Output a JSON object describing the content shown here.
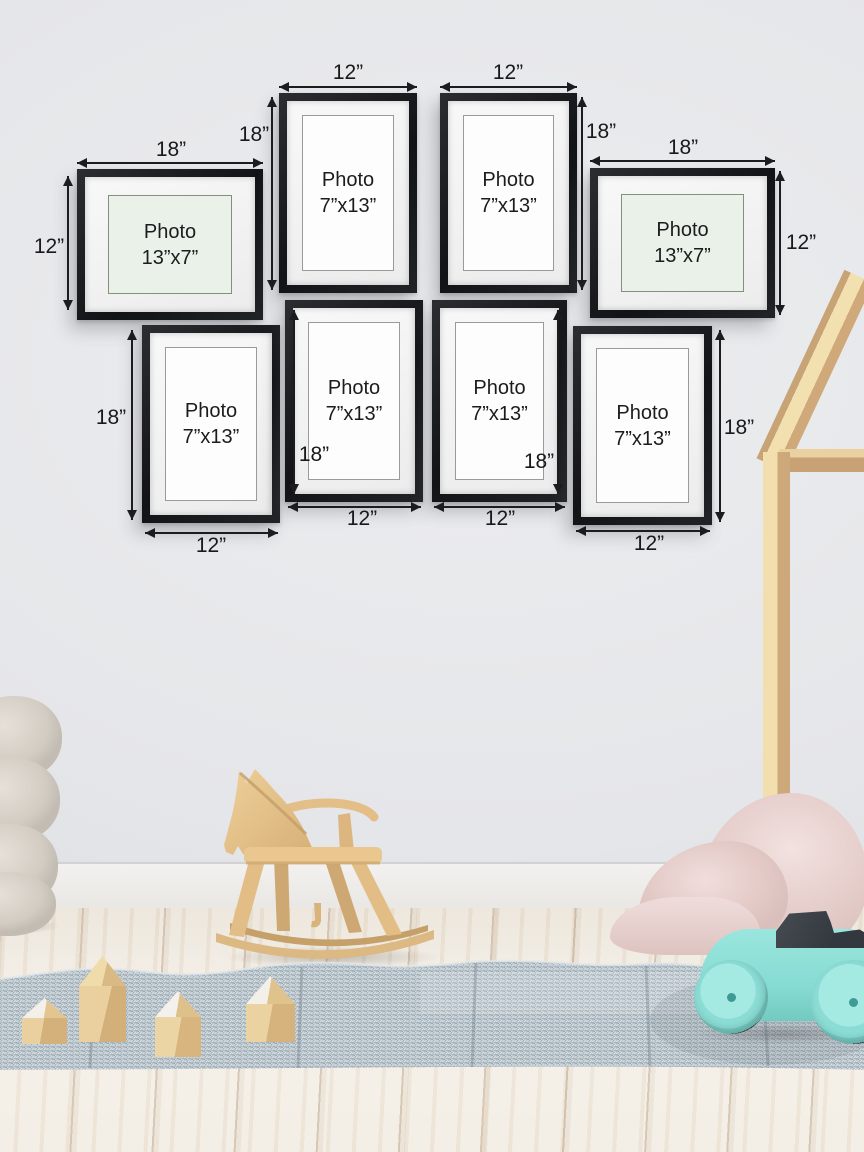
{
  "frames": [
    {
      "position": "top-left",
      "orientation": "landscape",
      "photo_line1": "Photo",
      "photo_line2": "13”x7”",
      "width_label": "18”",
      "height_label": "12”"
    },
    {
      "position": "top-middle-left",
      "orientation": "portrait",
      "photo_line1": "Photo",
      "photo_line2": "7”x13”",
      "width_label": "12”",
      "height_label": "18”"
    },
    {
      "position": "top-middle-right",
      "orientation": "portrait",
      "photo_line1": "Photo",
      "photo_line2": "7”x13”",
      "width_label": "12”",
      "height_label": "18”"
    },
    {
      "position": "top-right",
      "orientation": "landscape",
      "photo_line1": "Photo",
      "photo_line2": "13”x7”",
      "width_label": "18”",
      "height_label": "12”"
    },
    {
      "position": "bottom-left",
      "orientation": "portrait",
      "photo_line1": "Photo",
      "photo_line2": "7”x13”",
      "width_label": "12”",
      "height_label": "18”"
    },
    {
      "position": "bottom-middle-left",
      "orientation": "portrait",
      "photo_line1": "Photo",
      "photo_line2": "7”x13”",
      "width_label": "12”",
      "height_label": "18”"
    },
    {
      "position": "bottom-middle-right",
      "orientation": "portrait",
      "photo_line1": "Photo",
      "photo_line2": "7”x13”",
      "width_label": "12”",
      "height_label": "18”"
    },
    {
      "position": "bottom-right",
      "orientation": "portrait",
      "photo_line1": "Photo",
      "photo_line2": "7”x13”",
      "width_label": "12”",
      "height_label": "18”"
    }
  ],
  "colors": {
    "annotation": "#1c1c1e",
    "frame_black": "#17181a",
    "mat_white": "#f3f3f4",
    "photo_mint": "#eaf1e9",
    "photo_white": "#fdfdfd",
    "wall_gray": "#e5e6e9",
    "floor_white_wood": "#f2ede4",
    "rug_blue_gray": "#b4c0c8",
    "wood_natural": "#e6c38c",
    "car_mint": "#8adcd4",
    "car_seat_charcoal": "#383d43",
    "blanket_pink": "#e7d0cd",
    "pouf_cream": "#d8d2ca"
  }
}
